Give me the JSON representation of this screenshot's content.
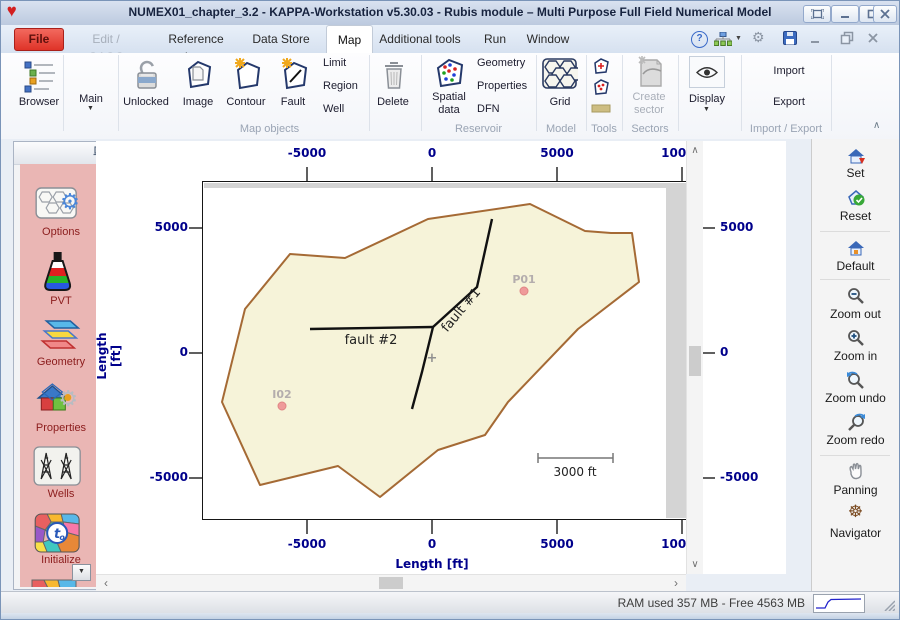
{
  "window": {
    "title": "NUMEX01_chapter_3.2 - KAPPA-Workstation v5.30.03 - Rubis module – Multi Purpose Full Field Numerical Model"
  },
  "menu": {
    "file_label": "File",
    "items": [
      "Edit / QAQC",
      "Reference logs",
      "Data Store",
      "Map",
      "Additional tools",
      "Run",
      "Window"
    ]
  },
  "ribbon": {
    "browser": "Browser",
    "main": "Main",
    "unlocked": "Unlocked",
    "image": "Image",
    "contour": "Contour",
    "fault": "Fault",
    "limit": "Limit",
    "region": "Region",
    "well": "Well",
    "delete": "Delete",
    "spatial_1": "Spatial",
    "spatial_2": "data",
    "geometry": "Geometry",
    "properties": "Properties",
    "dfn": "DFN",
    "grid": "Grid",
    "create_1": "Create",
    "create_2": "sector",
    "display": "Display",
    "import": "Import",
    "export": "Export",
    "groups": {
      "map_objects": "Map objects",
      "reservoir": "Reservoir",
      "model": "Model",
      "tools": "Tools",
      "sectors": "Sectors",
      "import_export": "Import / Export"
    }
  },
  "sidebar": {
    "items": [
      "Options",
      "PVT",
      "Geometry",
      "Properties",
      "Wells",
      "Initialize"
    ]
  },
  "map": {
    "x_ticks": [
      "-5000",
      "0",
      "5000",
      "10000"
    ],
    "y_ticks": [
      "5000",
      "0",
      "-5000"
    ],
    "x_label": "Length [ft]",
    "y_label": "Length [ft]",
    "faults": [
      {
        "name": "fault #1"
      },
      {
        "name": "fault #2"
      }
    ],
    "wells": [
      {
        "name": "P01"
      },
      {
        "name": "I02"
      }
    ],
    "scale_label": "3000 ft",
    "origin_marker": "+"
  },
  "right_toolbar": {
    "items": [
      "Set",
      "Reset",
      "Default",
      "Zoom out",
      "Zoom in",
      "Zoom undo",
      "Zoom redo",
      "Panning",
      "Navigator"
    ]
  },
  "status": {
    "ram": "RAM used 357 MB - Free 4563 MB"
  },
  "icons": {
    "dropdown": "▼",
    "gear": "⚙",
    "help": "?",
    "navigator": "☸",
    "up": "∧",
    "down": "∨",
    "left": "‹",
    "right": "›",
    "collapse": "∧"
  },
  "colors": {
    "accent_red": "#df3328",
    "navy": "#00008b",
    "panel_pink": "#eab6b4",
    "maroon": "#8b1c1c",
    "polygon_fill": "#f6f3d9",
    "polygon_stroke": "#a56a35",
    "well_dot": "#ef9a9a"
  }
}
